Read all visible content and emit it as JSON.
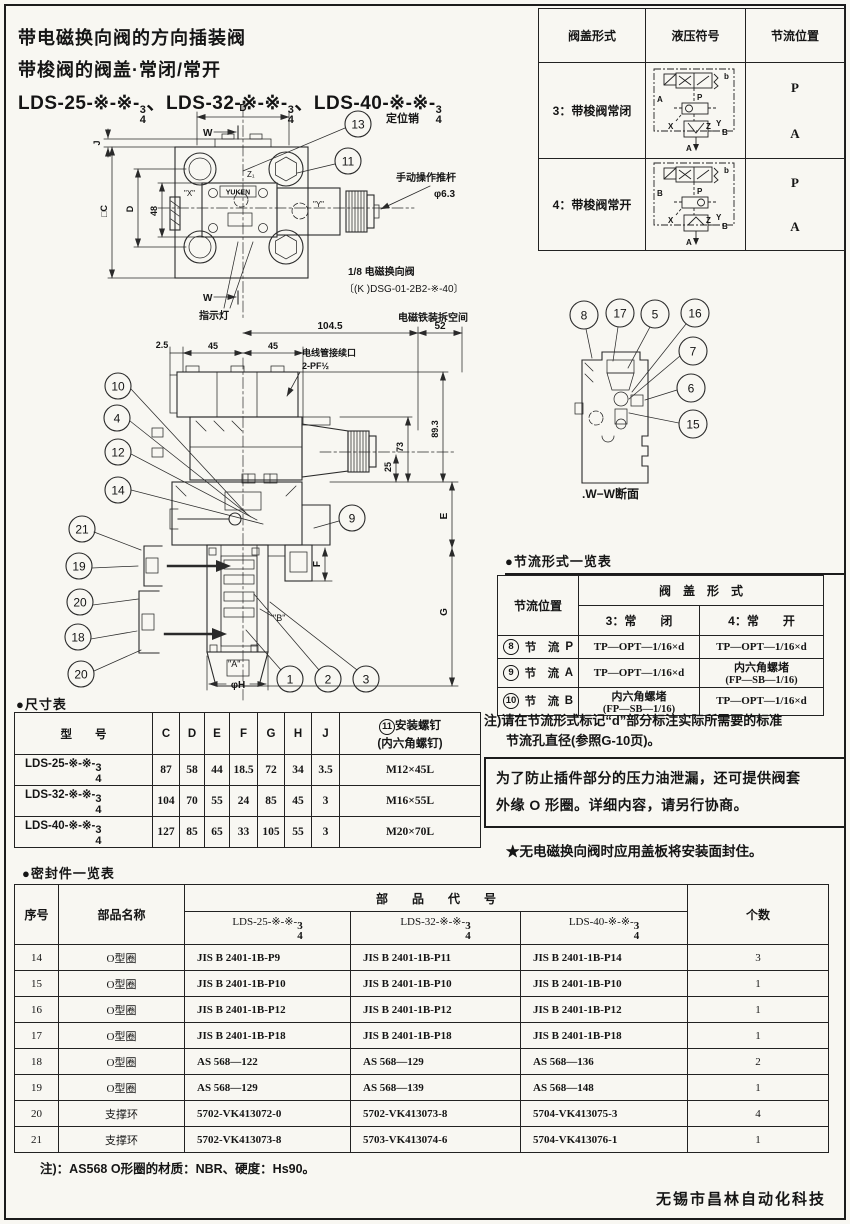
{
  "header": {
    "title1": "带电磁换向阀的方向插装阀",
    "title2": "带梭阀的阀盖·常闭/常开",
    "m1": "LDS-25-※-※-",
    "m2": "LDS-32-※-※-",
    "m3": "LDS-40-※-※-",
    "frac_num": "3",
    "frac_den": "4",
    "sep": "、"
  },
  "cover_table": {
    "h_form": "阀盖形式",
    "h_symbol": "液压符号",
    "h_pos": "节流位置",
    "rows": [
      {
        "form": "3：带梭阀常闭",
        "p": "P",
        "a": "A",
        "sym": {
          "left": "A",
          "b": "b",
          "pp": "P",
          "x": "X",
          "z": "Z",
          "y": "Y",
          "b2": "B",
          "a2": "A"
        }
      },
      {
        "form": "4：带梭阀常开",
        "p": "P",
        "a": "A",
        "sym": {
          "left": "B",
          "b": "b",
          "pp": "P",
          "x": "X",
          "z": "Z",
          "y": "Y",
          "b2": "B",
          "a2": "A"
        }
      }
    ]
  },
  "plan": {
    "c13": "13",
    "c11": "11",
    "pin_label": "定位销",
    "rod_label": "手动操作推杆",
    "rod_dia": "φ6.3",
    "indicator": "指示灯",
    "sol1": "1/8 电磁换向阀",
    "sol2": "〔(K )DSG-01-2B2-※-40〕",
    "dim_d_top": "D",
    "w_top": "W",
    "w_bot": "W",
    "dim_j": "J",
    "dim_c": "□C",
    "dim_d_left": "D",
    "dim_48": "48",
    "lx": "\"X\"",
    "lz": "Z₁",
    "ly": "\"Y\"",
    "yuken": "YUKEN"
  },
  "front": {
    "removal": "电磁铁装拆空间",
    "d52": "52",
    "d1045": "104.5",
    "d25": "2.5",
    "d45a": "45",
    "d45b": "45",
    "conduit1": "电线管接续口",
    "conduit2": "2-PF½",
    "d73": "73",
    "d893": "89.3",
    "d25b": "25",
    "de": "E",
    "df": "F",
    "dg": "G",
    "phih": "φH",
    "la": "\"A\"",
    "lb": "\"B\"",
    "c9": "9",
    "c1": "1",
    "c2": "2",
    "c3": "3",
    "c10": "10",
    "c4": "4",
    "c12": "12",
    "c14": "14",
    "c21": "21",
    "c19": "19",
    "c20a": "20",
    "c18": "18",
    "c20b": "20"
  },
  "section": {
    "caption": ".W−W断面",
    "c8": "8",
    "c17": "17",
    "c5": "5",
    "c16": "16",
    "c7": "7",
    "c6": "6",
    "c15": "15"
  },
  "throttle_table": {
    "title": "●节流形式一览表",
    "h_pos": "节流位置",
    "h_form": "阀　盖　形　式",
    "h_closed": "3：常　　闭",
    "h_open": "4：常　　开",
    "rows": [
      {
        "num": "8",
        "pos": "节　流",
        "letter": "P",
        "closed": "TP—OPT—1/16×d",
        "open": "TP—OPT—1/16×d"
      },
      {
        "num": "9",
        "pos": "节　流",
        "letter": "A",
        "closed": "TP—OPT—1/16×d",
        "open": "内六角螺堵",
        "open2": "(FP—SB—1/16)"
      },
      {
        "num": "10",
        "pos": "节　流",
        "letter": "B",
        "closed": "内六角螺堵",
        "closed2": "(FP—SB—1/16)",
        "open": "TP—OPT—1/16×d"
      }
    ],
    "note1": "注)请在节流形式标记“d”部分标注实际所需要的标准",
    "note2": "节流孔直径(参照G-10页)。"
  },
  "notice": {
    "box1": "为了防止插件部分的压力油泄漏，还可提供阀套",
    "box2": "外缘 O 形圈。详细内容，请另行协商。",
    "star": "★无电磁换向阀时应用盖板将安装面封住。"
  },
  "dim_table": {
    "title": "●尺寸表",
    "h_model": "型　　号",
    "h_c": "C",
    "h_d": "D",
    "h_e": "E",
    "h_f": "F",
    "h_g": "G",
    "h_h": "H",
    "h_j": "J",
    "h_screw_num": "11",
    "h_screw1": "安装螺钉",
    "h_screw2": "(内六角螺钉)",
    "rows": [
      {
        "model": "LDS-25-※-※-",
        "c": "87",
        "d": "58",
        "e": "44",
        "f": "18.5",
        "g": "72",
        "h": "34",
        "j": "3.5",
        "screw": "M12×45L"
      },
      {
        "model": "LDS-32-※-※-",
        "c": "104",
        "d": "70",
        "e": "55",
        "f": "24",
        "g": "85",
        "h": "45",
        "j": "3",
        "screw": "M16×55L"
      },
      {
        "model": "LDS-40-※-※-",
        "c": "127",
        "d": "85",
        "e": "65",
        "f": "33",
        "g": "105",
        "h": "55",
        "j": "3",
        "screw": "M20×70L"
      }
    ]
  },
  "seal_table": {
    "title": "●密封件一览表",
    "h_no": "序号",
    "h_name": "部品名称",
    "h_code": "部　　品　　代　　号",
    "h_qty": "个数",
    "hm1": "LDS-25-※-※-",
    "hm2": "LDS-32-※-※-",
    "hm3": "LDS-40-※-※-",
    "rows": [
      {
        "no": "14",
        "name": "O型圈",
        "c1": "JIS B 2401-1B-P9",
        "c2": "JIS B 2401-1B-P11",
        "c3": "JIS B 2401-1B-P14",
        "qty": "3"
      },
      {
        "no": "15",
        "name": "O型圈",
        "c1": "JIS B 2401-1B-P10",
        "c2": "JIS B 2401-1B-P10",
        "c3": "JIS B 2401-1B-P10",
        "qty": "1"
      },
      {
        "no": "16",
        "name": "O型圈",
        "c1": "JIS B 2401-1B-P12",
        "c2": "JIS B 2401-1B-P12",
        "c3": "JIS B 2401-1B-P12",
        "qty": "1"
      },
      {
        "no": "17",
        "name": "O型圈",
        "c1": "JIS B 2401-1B-P18",
        "c2": "JIS B 2401-1B-P18",
        "c3": "JIS B 2401-1B-P18",
        "qty": "1"
      },
      {
        "no": "18",
        "name": "O型圈",
        "c1": "AS 568—122",
        "c2": "AS 568—129",
        "c3": "AS 568—136",
        "qty": "2"
      },
      {
        "no": "19",
        "name": "O型圈",
        "c1": "AS 568—129",
        "c2": "AS 568—139",
        "c3": "AS 568—148",
        "qty": "1"
      },
      {
        "no": "20",
        "name": "支撑环",
        "c1": "5702-VK413072-0",
        "c2": "5702-VK413073-8",
        "c3": "5704-VK413075-3",
        "qty": "4"
      },
      {
        "no": "21",
        "name": "支撑环",
        "c1": "5702-VK413073-8",
        "c2": "5703-VK413074-6",
        "c3": "5704-VK413076-1",
        "qty": "1"
      }
    ],
    "note": "注)：AS568 O形圈的材质：NBR、硬度：Hs90。"
  },
  "footer": {
    "company": "无锡市昌林自动化科技"
  },
  "colors": {
    "ink": "#1c1c1c",
    "paper": "#f8f7f2"
  }
}
